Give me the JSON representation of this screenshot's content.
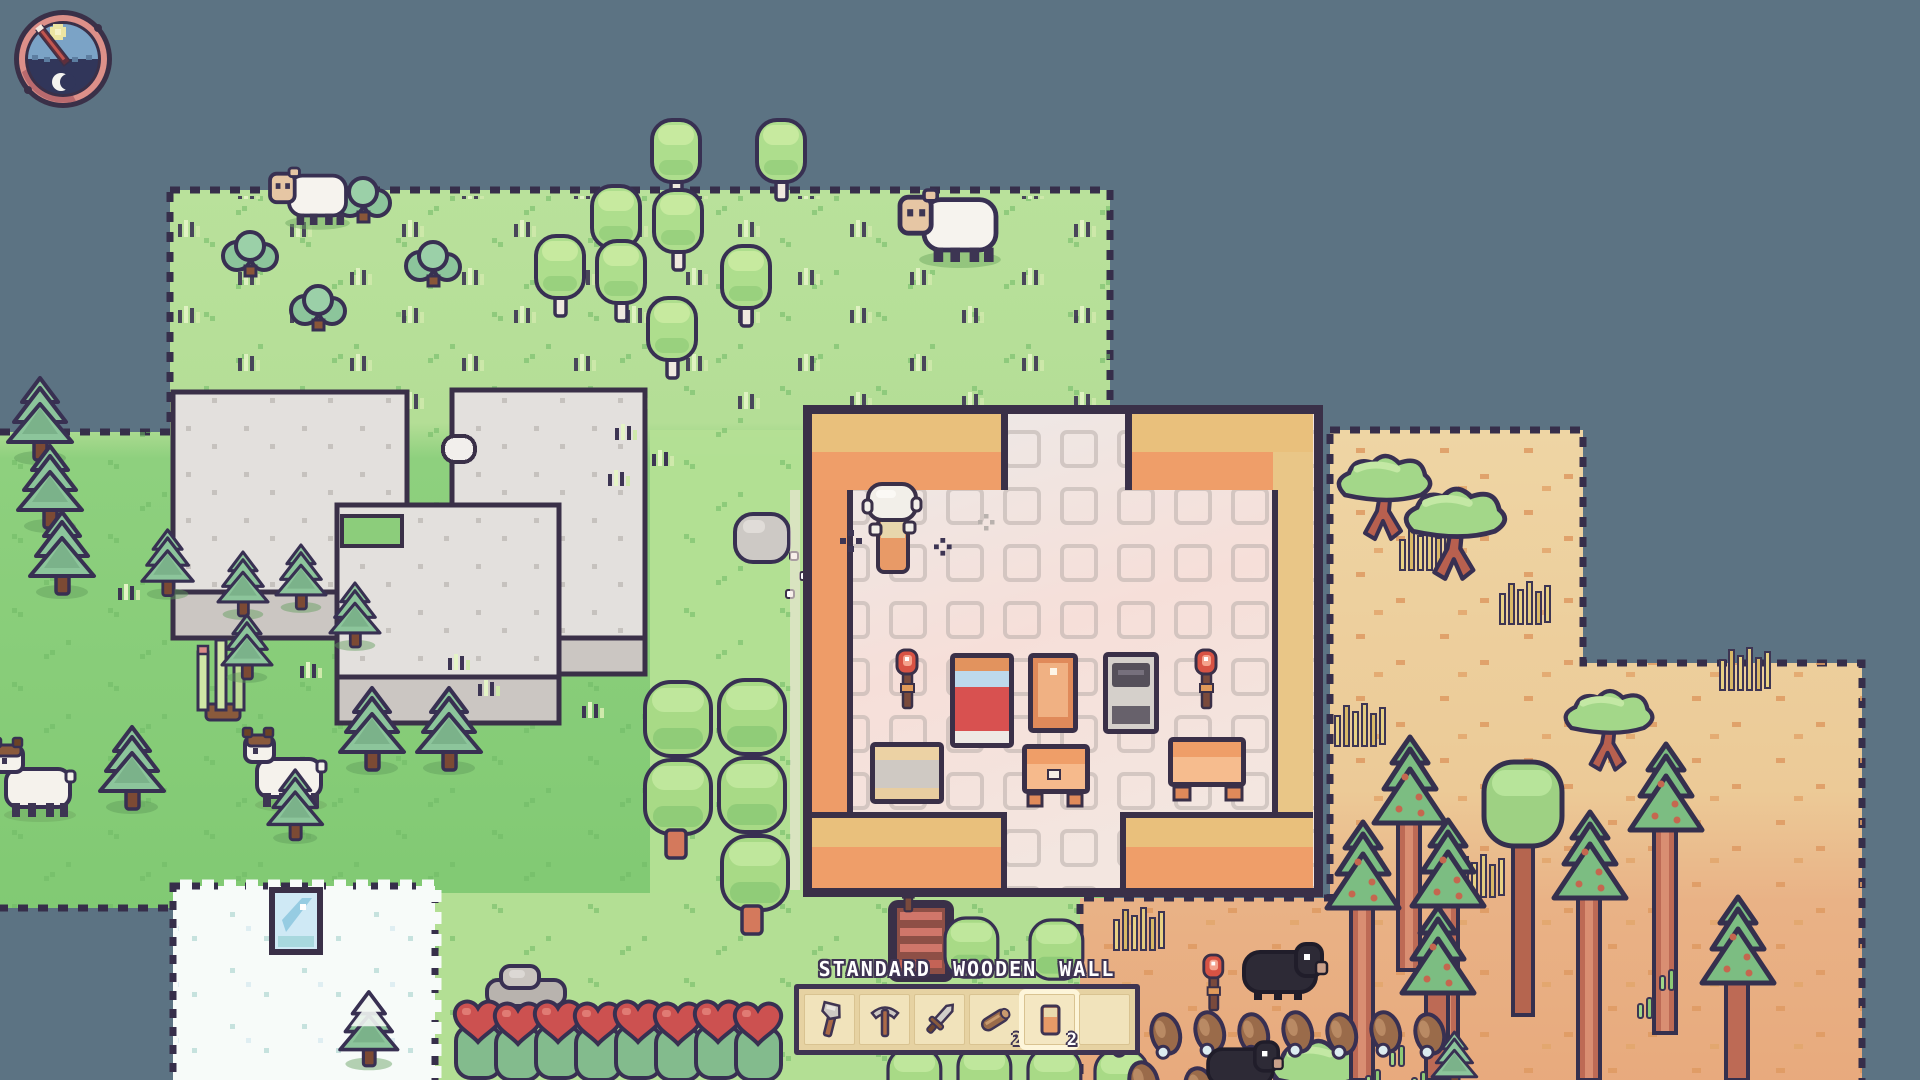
{
  "hud": {
    "clock": {
      "name": "day-night-clock",
      "phase": "day",
      "symbols": [
        "sun",
        "crescent-moon"
      ],
      "hand_direction": "upper-right"
    },
    "item_tooltip": "STANDARD WOODEN WALL",
    "hotbar": {
      "selected_slot": 5,
      "slots": [
        {
          "item": "axe",
          "icon": "axe-icon",
          "count": ""
        },
        {
          "item": "pickaxe",
          "icon": "pickaxe-icon",
          "count": ""
        },
        {
          "item": "sword",
          "icon": "sword-icon",
          "count": ""
        },
        {
          "item": "wood log",
          "icon": "wood-log-icon",
          "count": "2"
        },
        {
          "item": "standard wooden wall",
          "icon": "wooden-wall-icon",
          "count": "2",
          "selected": true
        },
        {
          "item": "",
          "icon": "empty-slot",
          "count": ""
        }
      ]
    }
  },
  "world": {
    "biomes": [
      "grassland",
      "snow",
      "savanna"
    ],
    "creatures": [
      "sheep",
      "goat",
      "dark-boar"
    ],
    "structures": [
      "stone-ruins",
      "wooden-house",
      "ladder-hatch"
    ],
    "player": {
      "holding": "wooden wall"
    }
  },
  "colors": {
    "background": "#5c7383",
    "grass_light": "#b7e098",
    "grass_dark": "#7ec96f",
    "sand": "#eed3a0",
    "snow": "#f7fbf9",
    "house_wall_top": "#e9c07c",
    "house_wall_face": "#ef9e69",
    "floor": "#f2e2dd",
    "outline": "#3a3048",
    "ui_border": "#3f3452",
    "ui_panel": "#e6d2a2",
    "ui_slot": "#f1e3bb",
    "ui_selected": "#fdf5d9",
    "tooltip_text": "#ffffff"
  }
}
